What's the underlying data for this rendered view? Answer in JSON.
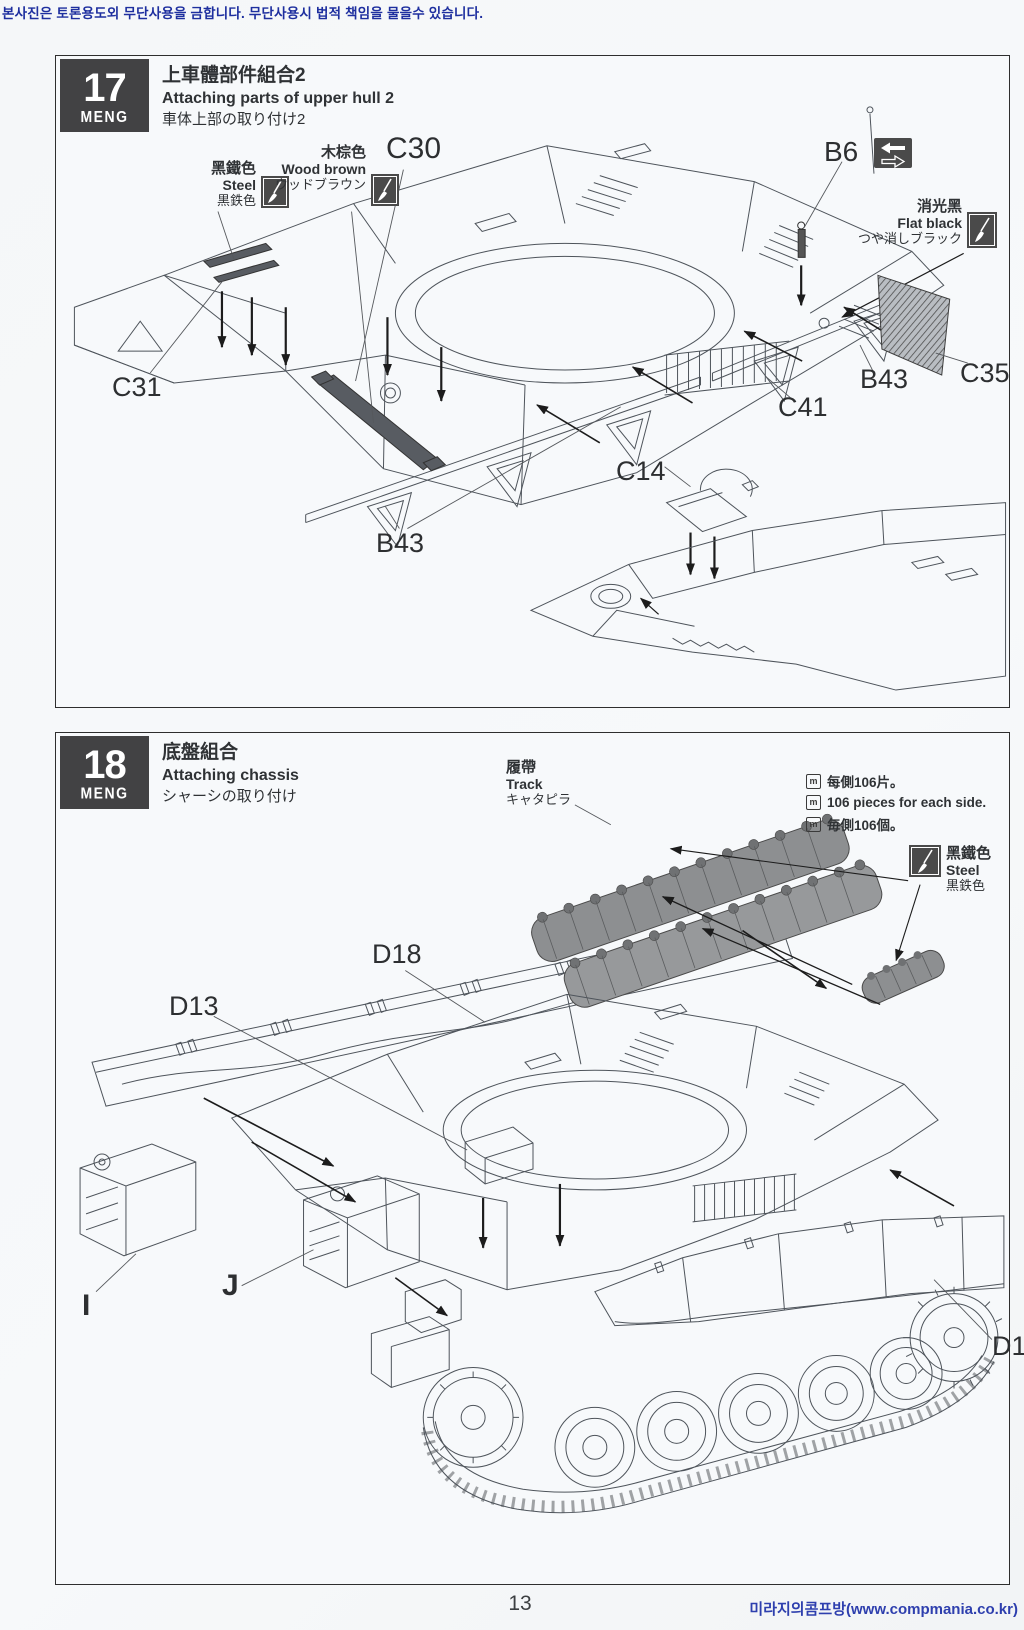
{
  "watermark_top": "본사진은 토론용도외 무단사용을 금합니다. 무단사용시 법적 책임을 물을수 있습니다.",
  "watermark_bottom": "미라지의콤프방(www.compmania.co.kr)",
  "page_number": "13",
  "brand": "MENG",
  "note_icon_glyph": "m",
  "colors": {
    "watermark_blue": "#1e2f9f",
    "url_blue": "#2e3fae",
    "line_art": "#4e545b",
    "badge_dark": "#424244",
    "paint_box_dark": "#4a4a4a",
    "track_gray": "#8d8f91",
    "hatch_panel": "#b9bdc2"
  },
  "step17": {
    "number": "17",
    "title_zh": "上車體部件組合2",
    "title_en": "Attaching parts of upper hull 2",
    "title_ja": "車体上部の取り付け2",
    "paints": {
      "steel": {
        "zh": "黑鐵色",
        "en": "Steel",
        "ja": "黒鉄色"
      },
      "wood_brown": {
        "zh": "木棕色",
        "en": "Wood brown",
        "ja": "ウッドブラウン"
      },
      "flat_black": {
        "zh": "消光黑",
        "en": "Flat black",
        "ja": "つや消しブラック"
      }
    },
    "part_labels": [
      "C30",
      "B6",
      "C31",
      "B43",
      "C41",
      "B43",
      "C35",
      "C14"
    ]
  },
  "step18": {
    "number": "18",
    "title_zh": "底盤組合",
    "title_en": "Attaching chassis",
    "title_ja": "シャーシの取り付け",
    "track_callout": {
      "zh": "履帶",
      "en": "Track",
      "ja": "キャタピラ"
    },
    "notes": [
      "每側106片。",
      "106 pieces for each side.",
      "毎側106個。"
    ],
    "paints": {
      "steel": {
        "zh": "黑鐵色",
        "en": "Steel",
        "ja": "黒鉄色"
      }
    },
    "part_labels": [
      "D18",
      "D13",
      "I",
      "J",
      "D1"
    ]
  }
}
